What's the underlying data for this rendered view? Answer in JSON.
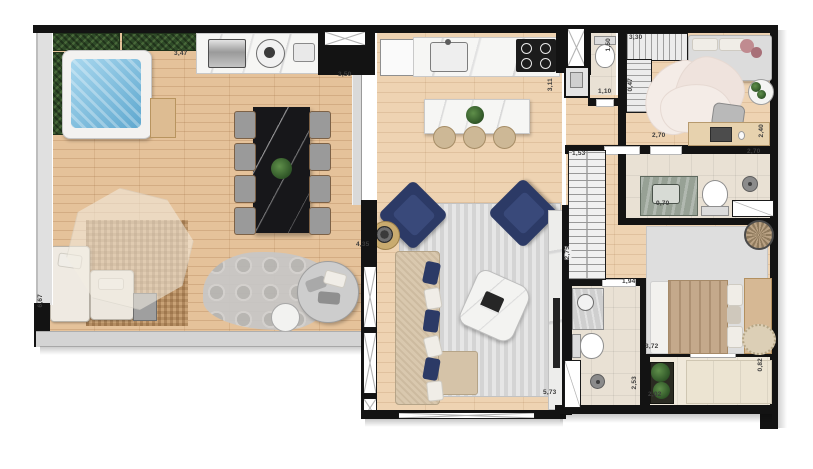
{
  "document": {
    "kind": "apartment-floor-plan",
    "background": "#ffffff"
  },
  "palette": {
    "wall": "#131313",
    "wood_deck": "#e5c29a",
    "wood_interior": "#eed3b2",
    "marble_white": "#f6f6f4",
    "marble_black": "#17171a",
    "jacuzzi_water": "#6fb4da",
    "hedge_green": "#2f4b28",
    "navy_accent": "#2c3a66",
    "rug_gray": "#dddddd",
    "sofa_beige": "#d9c8ae",
    "bath_tile": "#e9e1d4",
    "balcony_tile": "#f0e9db",
    "bed_tan": "#c4a98b",
    "label_text": "#3d3d3d"
  },
  "dims": {
    "counter_left": "3,47",
    "counter_right": "3,50",
    "wc_depth": "1,50",
    "closet_top": "3,30",
    "closet_depth": "0,47",
    "wc_door": "1,10",
    "kitchen_length": "3,11",
    "bedroom2_desk": "2,70",
    "bedroom2_width": "2,40",
    "hall_wardrobe": "1,53",
    "bath1_width": "2,70",
    "bath1_vanity": "0,70",
    "hall_length": "2,75",
    "bath2_door": "1,94",
    "bath2_length": "2,53",
    "bedroom1_length": "3,72",
    "balcony_width": "0,82",
    "balcony_length": "2,02",
    "living_length": "5,73",
    "living_width": "4,35",
    "terrace_length": "6,67"
  },
  "furniture_icons": [
    "hedge-planter",
    "jacuzzi",
    "deck-bench",
    "bbq-grill",
    "round-burner",
    "outdoor-sink",
    "dining-table",
    "dining-chair",
    "umbrella-shade",
    "wicker-mat",
    "outdoor-sofa",
    "coffee-table",
    "crochet-rug",
    "round-daybed",
    "side-table",
    "fridge",
    "kitchen-sink",
    "cooktop",
    "kitchen-island",
    "bar-stool",
    "ventilation-shaft-window",
    "washer",
    "toilet",
    "striped-rug",
    "navy-armchair",
    "sofa",
    "chaise",
    "lounge-chair",
    "gold-side-table",
    "tv-panel",
    "tv",
    "wardrobe",
    "closet",
    "bed",
    "petal-rug",
    "desk",
    "desk-chair",
    "laptop",
    "plant",
    "vanity",
    "shower-head",
    "shower-glass",
    "basket",
    "round-rug",
    "planter",
    "balcony-bench",
    "window",
    "sliding-glass-door",
    "door-opening"
  ]
}
